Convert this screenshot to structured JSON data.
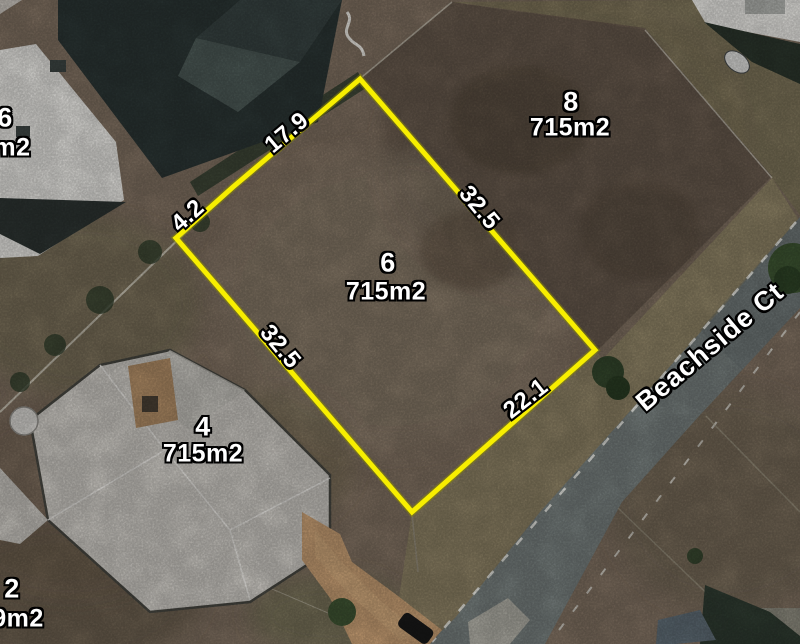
{
  "street": {
    "name": "Beachside Ct"
  },
  "lots": {
    "lot6": {
      "number": "6",
      "area": "715m2"
    },
    "lot8": {
      "number": "8",
      "area": "715m2"
    },
    "lot4": {
      "number": "4",
      "area": "715m2"
    },
    "lot2": {
      "number": "2",
      "area_partial": "9m2"
    },
    "lot_nw": {
      "number_partial": "6",
      "area_partial": "m2"
    }
  },
  "measurements": {
    "top": "17.9",
    "upper_left": "4.2",
    "left": "32.5",
    "right": "32.5",
    "bottom": "22.1"
  },
  "colors": {
    "boundary": "#f7ee00",
    "label_text": "#ffffff",
    "label_outline": "#000000"
  }
}
